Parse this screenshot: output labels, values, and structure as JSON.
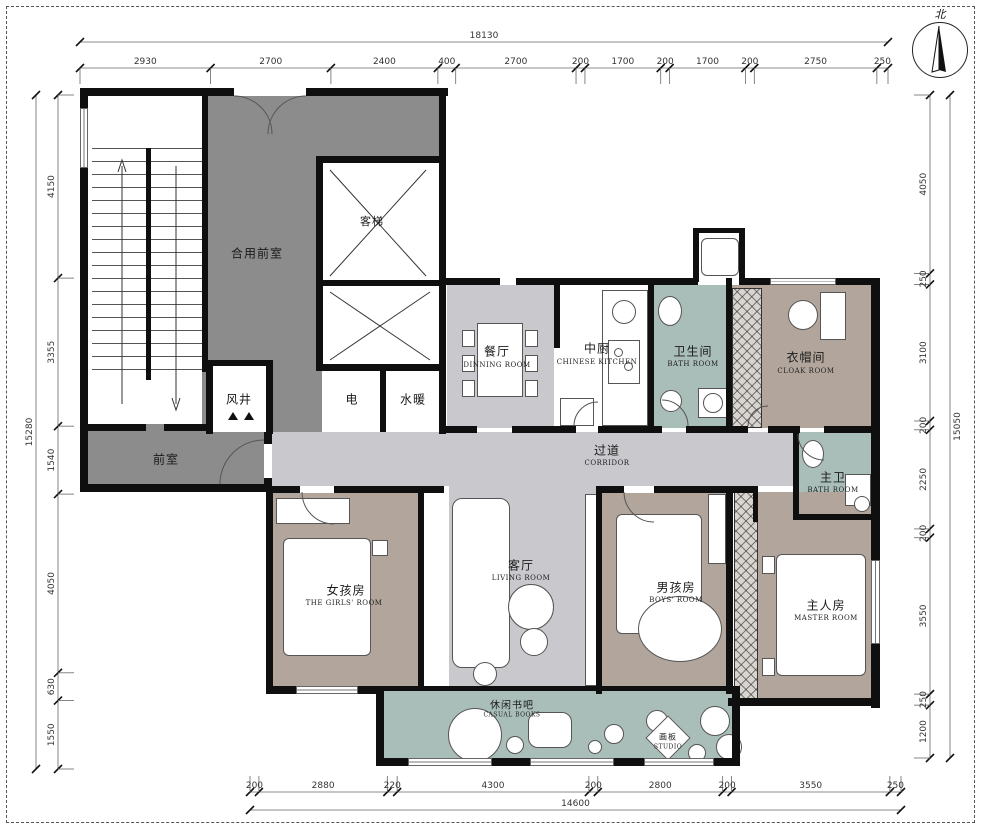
{
  "drawing": {
    "kind": "residential floor plan"
  },
  "compass": {
    "north_label": "北"
  },
  "dimensions": {
    "top": {
      "total": "18130",
      "segments": [
        "2930",
        "2700",
        "2400",
        "400",
        "2700",
        "200",
        "1700",
        "200",
        "1700",
        "200",
        "2750",
        "250"
      ]
    },
    "bottom": {
      "total": "14600",
      "segments": [
        "200",
        "2880",
        "220",
        "4300",
        "200",
        "2800",
        "200",
        "3550",
        "250"
      ]
    },
    "left": {
      "total": "15280",
      "segments": [
        "4150",
        "3355",
        "1540",
        "4050",
        "630",
        "1550"
      ]
    },
    "right": {
      "total": "15050",
      "segments": [
        "4050",
        "250",
        "3100",
        "200",
        "2250",
        "200",
        "3550",
        "250",
        "1200"
      ]
    }
  },
  "rooms": {
    "shared_lobby": {
      "cn": "合用前室",
      "en": ""
    },
    "elevator": {
      "cn": "客梯",
      "en": ""
    },
    "wind_shaft": {
      "cn": "风井",
      "en": ""
    },
    "electric": {
      "cn": "电",
      "en": ""
    },
    "plumbing": {
      "cn": "水暖",
      "en": ""
    },
    "vestibule": {
      "cn": "前室",
      "en": ""
    },
    "dining": {
      "cn": "餐厅",
      "en": "DINNING ROOM"
    },
    "kitchen": {
      "cn": "中厨",
      "en": "CHINESE KITCHEN"
    },
    "bath": {
      "cn": "卫生间",
      "en": "BATH ROOM"
    },
    "cloak": {
      "cn": "衣帽间",
      "en": "CLOAK ROOM"
    },
    "corridor": {
      "cn": "过道",
      "en": "CORRIDOR"
    },
    "master_bath": {
      "cn": "主卫",
      "en": "BATH ROOM"
    },
    "girls_room": {
      "cn": "女孩房",
      "en": "THE GIRLS' ROOM"
    },
    "living": {
      "cn": "客厅",
      "en": "LIVING ROOM"
    },
    "boys_room": {
      "cn": "男孩房",
      "en": "BOYS' ROOM"
    },
    "master_room": {
      "cn": "主人房",
      "en": "MASTER ROOM"
    },
    "book_bar": {
      "cn": "休闲书吧",
      "en": "CASUAL BOOKS"
    },
    "studio": {
      "cn": "画板",
      "en": "STUDIO"
    }
  },
  "colors": {
    "wall": "#0f0f0f",
    "lobby_gray": "#8c8c8c",
    "circulation_gray": "#c9c9cd",
    "bath_teal": "#a9bdb9",
    "bedroom_taupe": "#b2a69c"
  }
}
